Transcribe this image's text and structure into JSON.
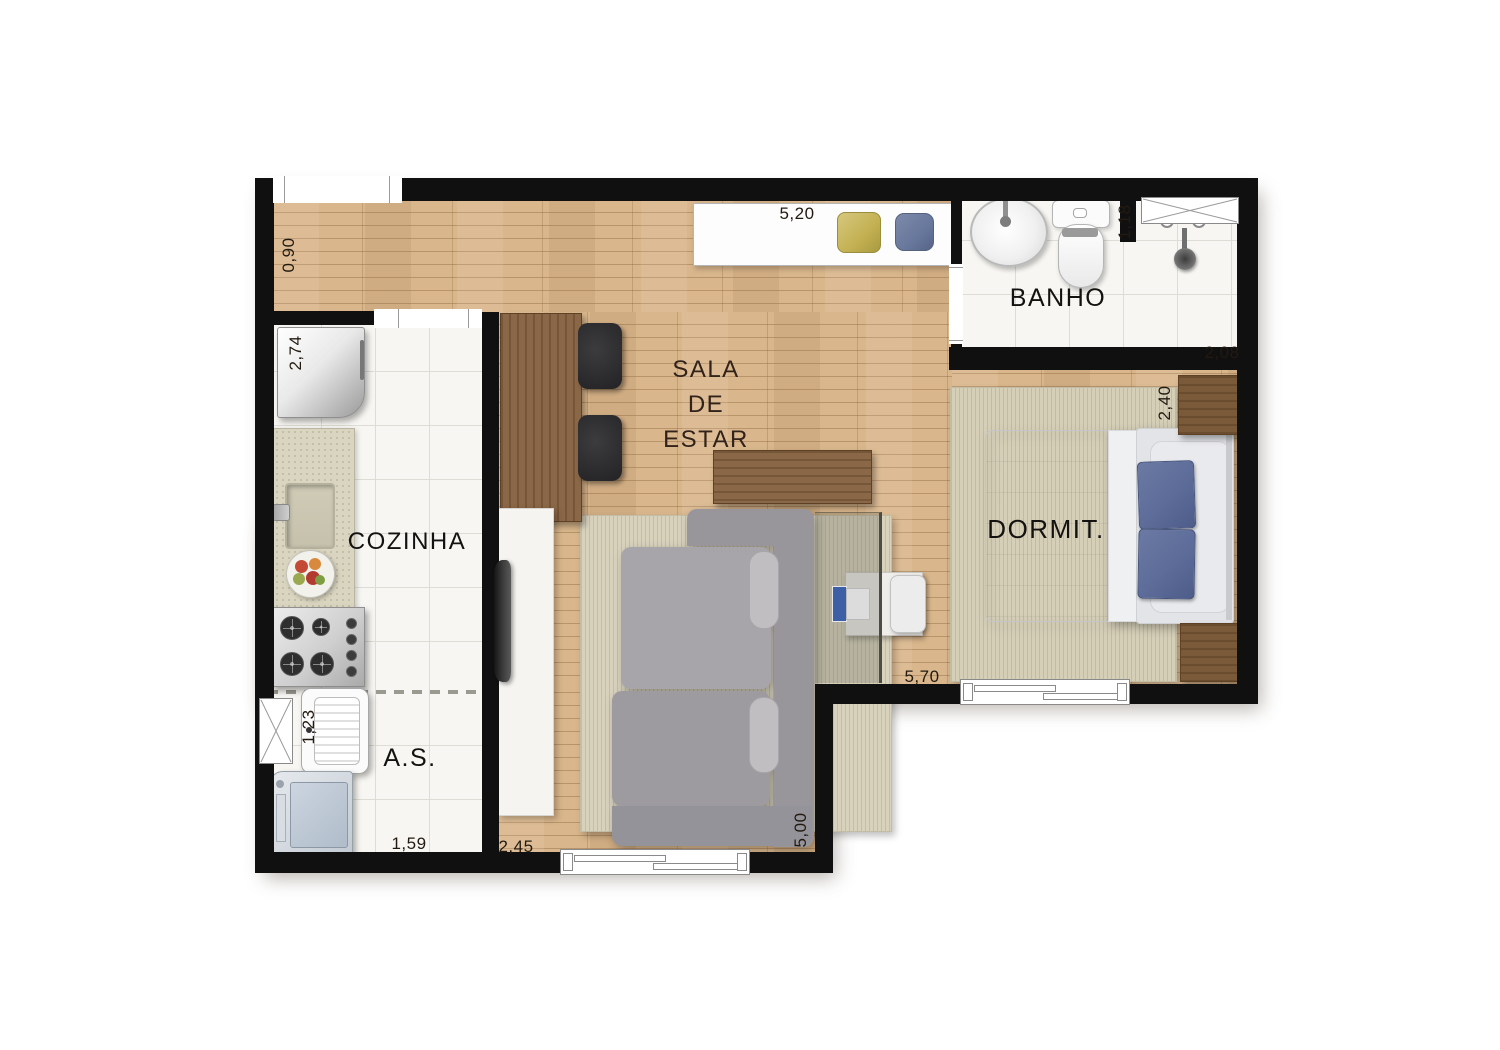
{
  "title": "Apartment floor plan",
  "rooms": {
    "living": {
      "l1": "SALA",
      "l2": "DE",
      "l3": "ESTAR"
    },
    "kitchen": {
      "label": "COZINHA"
    },
    "bathroom": {
      "label": "BANHO"
    },
    "bedroom": {
      "label": "DORMIT."
    },
    "service": {
      "label": "A.S."
    }
  },
  "dimensions": {
    "corridor_width": "0,90",
    "top_span": "5,20",
    "bath_niche_depth": "1,18",
    "kitchen_depth": "2,74",
    "bath_width": "2,08",
    "bedroom_depth": "2,40",
    "living_span": "5,70",
    "service_width": "1,59",
    "living_width": "2,45",
    "living_depth": "5,00",
    "service_depth": "1,23"
  },
  "colors": {
    "wall": "#101010",
    "wood_floor": "#d9b68c",
    "tile_floor": "#f7f6f2",
    "rug": "#d8d2bd",
    "sofa_gray": "#98969b",
    "furniture_wood": "#8a6746",
    "pillow_blue": "#5d6c99",
    "decor_yellow": "#c3b052",
    "decor_blue": "#68779c"
  }
}
